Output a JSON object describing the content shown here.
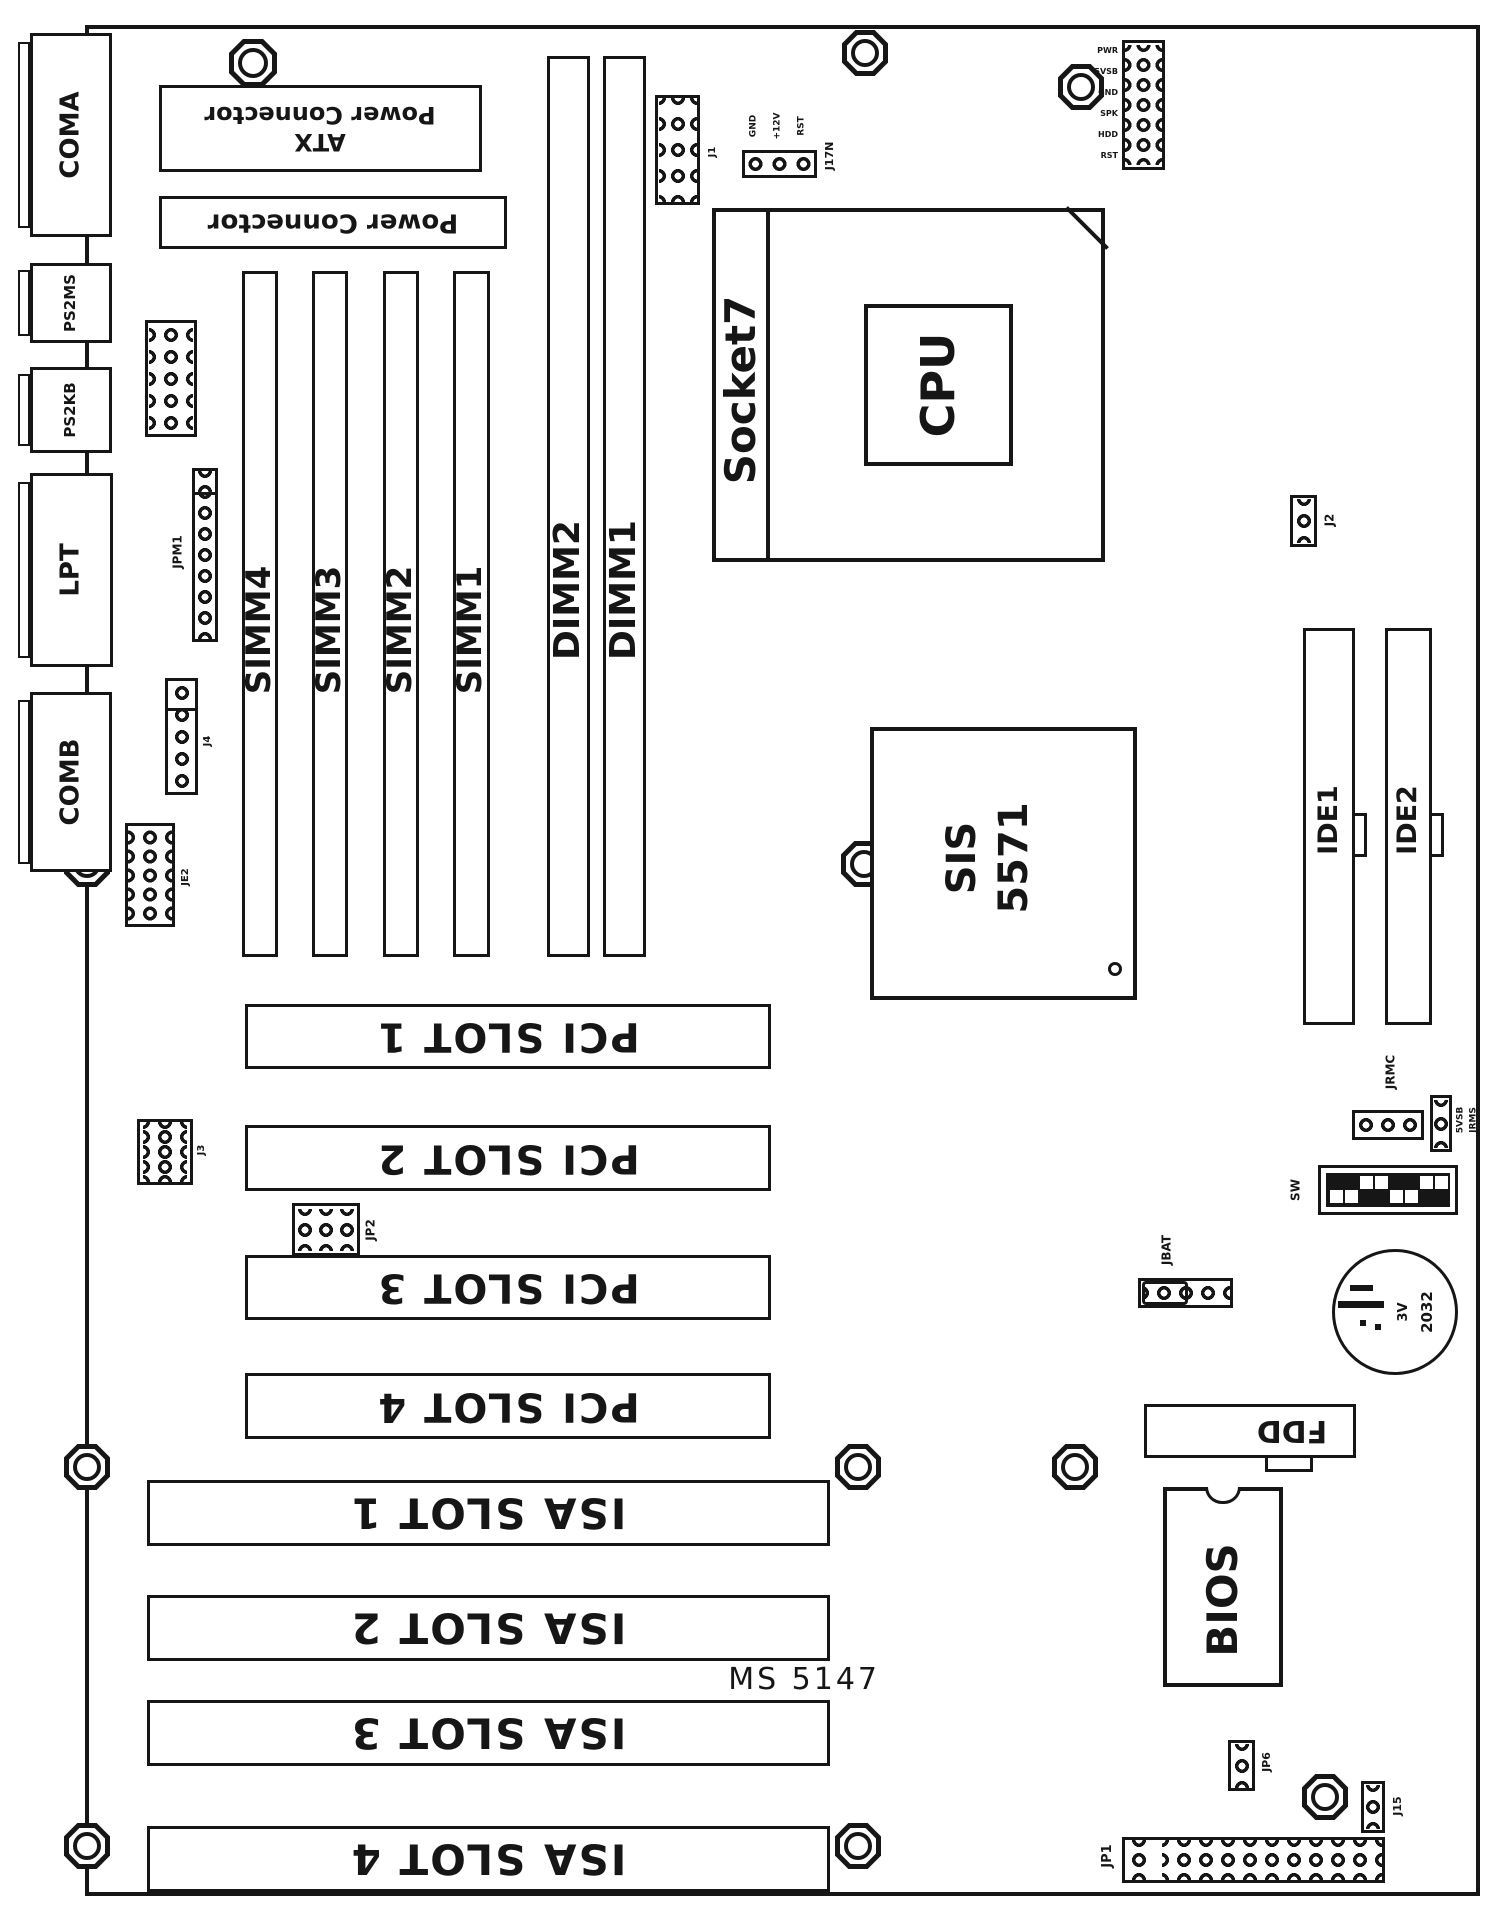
{
  "model": {
    "label": "MS 5147"
  },
  "ports": {
    "coma": "COMA",
    "ps2ms": "PS2MS",
    "ps2kb": "PS2KB",
    "lpt": "LPT",
    "comb": "COMB"
  },
  "power": {
    "atx_title": "ATX",
    "atx_subtitle": "Power Connector",
    "at_title": "Power Connector"
  },
  "memory": {
    "simm4": "SIMM4",
    "simm3": "SIMM3",
    "simm2": "SIMM2",
    "simm1": "SIMM1",
    "dimm2": "DIMM2",
    "dimm1": "DIMM1"
  },
  "cpu": {
    "socket": "Socket7",
    "label": "CPU"
  },
  "chipset": {
    "vendor": "SIS",
    "model": "5571"
  },
  "slots": {
    "pci1": "PCI SLOT 1",
    "pci2": "PCI SLOT 2",
    "pci3": "PCI SLOT 3",
    "pci4": "PCI SLOT 4",
    "isa1": "ISA SLOT 1",
    "isa2": "ISA SLOT 2",
    "isa3": "ISA SLOT 3",
    "isa4": "ISA SLOT 4"
  },
  "storage": {
    "ide1": "IDE1",
    "ide2": "IDE2",
    "fdd": "FDD"
  },
  "bios": {
    "label": "BIOS"
  },
  "battery": {
    "voltage": "3V",
    "type": "2032"
  },
  "jumpers": {
    "jpm1": "JPM1",
    "j4": "J4",
    "je2": "JE2",
    "j3": "J3",
    "jp2": "JP2",
    "j1": "J1",
    "j17n": "J17N",
    "j2": "J2",
    "jrmc": "JRMC",
    "jrms": "JRMS",
    "v5sb": "5VSB",
    "sw": "SW",
    "jbat": "JBAT",
    "jp6": "JP6",
    "j15": "J15",
    "jp1": "JP1"
  },
  "pin_labels": {
    "fan": [
      "GND",
      "+12V",
      "RST"
    ],
    "panel": [
      "PWR",
      "5VSB",
      "GND",
      "SPK",
      "HDD",
      "RST"
    ]
  },
  "colors": {
    "ink": "#161616",
    "paper": "#ffffff"
  }
}
